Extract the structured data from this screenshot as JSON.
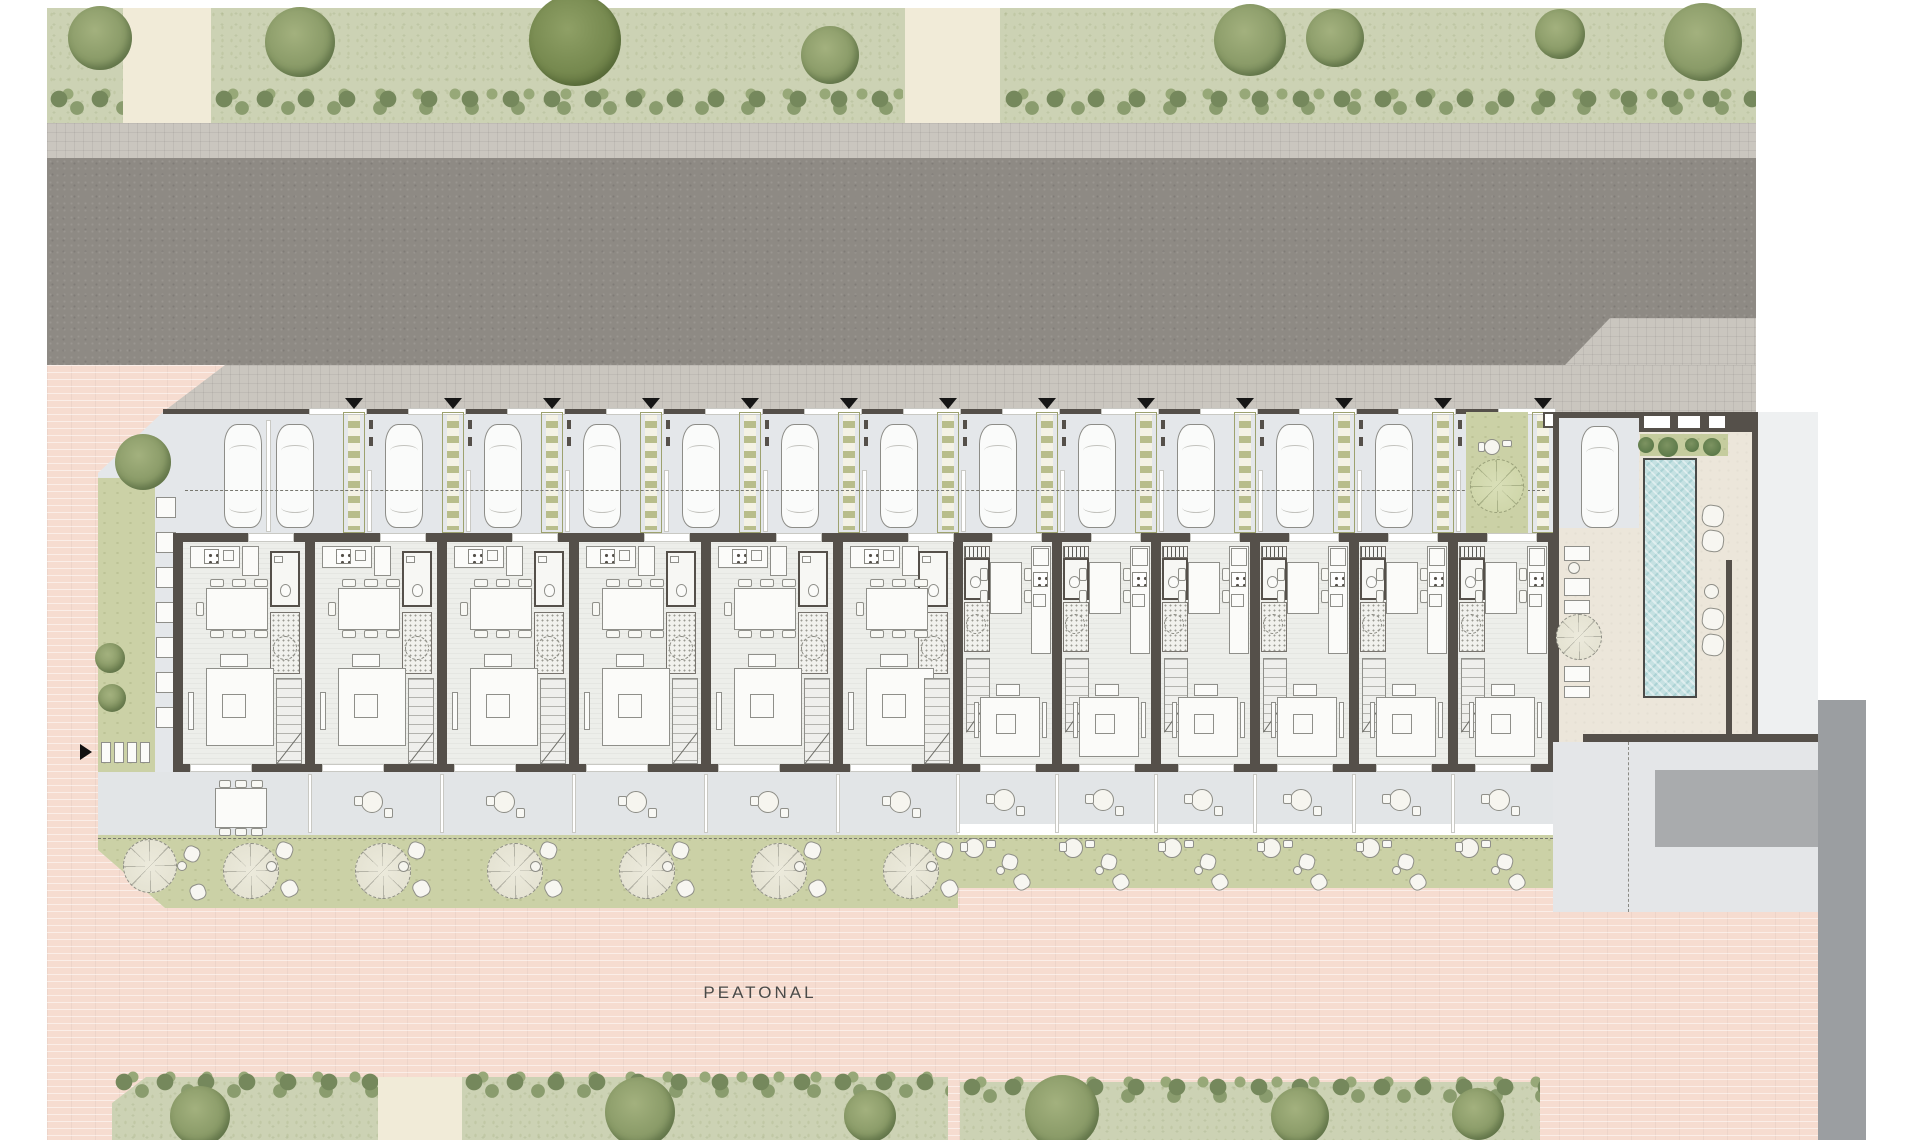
{
  "text": {
    "peatonal": "PEATONAL"
  },
  "colors": {
    "asphalt": "#8e8a84",
    "sidewalk": "#cac6bf",
    "verge_green": "#ccd2b4",
    "pedestrian_pink": "#f6dcd0",
    "garden_green": "#cbd1a6",
    "court_gray": "#e4e7ea",
    "wall_umber": "#55504a",
    "pool_water": "#c5e1e2",
    "terrace_beige": "#ece6da",
    "ladder_olive": "#b8bd8b",
    "ramp_gray": "#a9abad",
    "band_gray": "#9b9ea1"
  },
  "site": {
    "townhouse_count": 12,
    "wide_unit_count": 6,
    "narrow_unit_count": 6,
    "parking_bay_count": 13,
    "entry_marker_count": 13,
    "pool": true,
    "pedestrian_promenade": true
  },
  "units": {
    "wide": [
      [
        178,
        132
      ],
      [
        310,
        132
      ],
      [
        442,
        132
      ],
      [
        574,
        132
      ],
      [
        706,
        132
      ],
      [
        838,
        120
      ]
    ],
    "narrow": [
      [
        958,
        99
      ],
      [
        1057,
        99
      ],
      [
        1156,
        99
      ],
      [
        1255,
        99
      ],
      [
        1354,
        99
      ],
      [
        1453,
        100
      ]
    ]
  },
  "parking": {
    "ladder_centers": [
      354,
      453,
      552,
      651,
      750,
      849,
      948,
      1047,
      1146,
      1245,
      1344,
      1443,
      1543
    ],
    "car_centers": [
      243,
      295,
      404,
      503,
      602,
      701,
      800,
      899,
      998,
      1097,
      1196,
      1295,
      1394
    ],
    "car_y": 424,
    "car_w": 38,
    "car_h": 104,
    "guest_car": [
      1581,
      426
    ],
    "dashed_line_y": 490,
    "green_patch": [
      1466,
      412,
      62,
      121
    ]
  },
  "landscape": {
    "top_verge": [
      47,
      8,
      1709,
      115
    ],
    "top_paths": [
      [
        123,
        8,
        88
      ],
      [
        905,
        8,
        95
      ]
    ],
    "top_hedges": [
      [
        47,
        88,
        76
      ],
      [
        212,
        88,
        691
      ],
      [
        1002,
        88,
        754
      ]
    ],
    "top_trees": [
      [
        100,
        38,
        64
      ],
      [
        300,
        42,
        70
      ],
      [
        575,
        40,
        92
      ],
      [
        830,
        55,
        58
      ],
      [
        1250,
        40,
        72
      ],
      [
        1335,
        28,
        58
      ],
      [
        1560,
        34,
        50
      ],
      [
        1703,
        42,
        78
      ]
    ],
    "bottom_verges": [
      [
        112,
        1077,
        266,
        63
      ],
      [
        462,
        1077,
        486,
        63
      ],
      [
        960,
        1082,
        580,
        58
      ]
    ],
    "bottom_path": [
      378,
      1077,
      84,
      63
    ],
    "bottom_trees": [
      [
        200,
        1116,
        60
      ],
      [
        640,
        1112,
        70
      ],
      [
        870,
        1116,
        52
      ],
      [
        1062,
        1112,
        74
      ],
      [
        1300,
        1116,
        58
      ],
      [
        1478,
        1114,
        52
      ]
    ],
    "side_trees": [
      [
        143,
        462,
        56
      ],
      [
        110,
        658,
        30
      ],
      [
        112,
        698,
        28
      ]
    ],
    "patch_tree": [
      1497,
      486,
      54
    ]
  },
  "streets": {
    "road": [
      47,
      158,
      1709,
      207
    ],
    "sidewalk_north": [
      47,
      123,
      1709,
      35
    ],
    "sidewalk_south": [
      140,
      365,
      1616,
      47
    ]
  },
  "pool_court": {
    "block": [
      1553,
      412,
      205,
      330
    ],
    "water": [
      1643,
      458,
      54,
      240
    ],
    "planting_bed": [
      1640,
      434,
      88,
      22
    ],
    "skylights": [
      [
        1642,
        414,
        30,
        16
      ],
      [
        1676,
        414,
        26,
        16
      ],
      [
        1707,
        414,
        20,
        16
      ]
    ],
    "cushions_right": [
      [
        1702,
        505
      ],
      [
        1702,
        530
      ],
      [
        1702,
        608
      ],
      [
        1702,
        634
      ]
    ],
    "stool_right": [
      1704,
      584,
      15
    ],
    "deck_loungers": [
      [
        1564,
        578,
        26,
        18
      ],
      [
        1564,
        600,
        26,
        14
      ],
      [
        1564,
        666,
        26,
        16
      ],
      [
        1564,
        686,
        26,
        12
      ]
    ],
    "deck_table": [
      1564,
      546,
      26,
      15
    ],
    "deck_parasol": [
      1556,
      614,
      46
    ],
    "plaza": [
      1553,
      742,
      265,
      170
    ],
    "ramp": [
      1655,
      770,
      163,
      77
    ],
    "right_band": [
      1818,
      700,
      48,
      440
    ]
  }
}
